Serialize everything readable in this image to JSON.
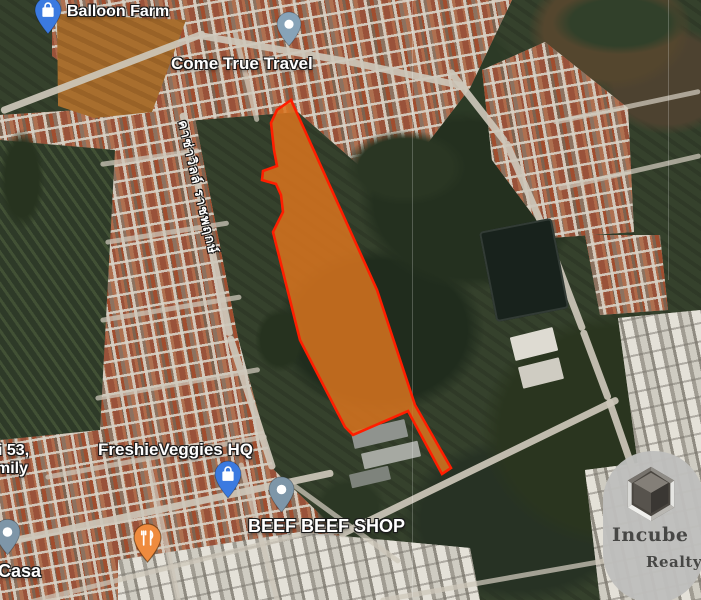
{
  "map": {
    "type": "satellite",
    "pois": {
      "balloon_farm": {
        "label": "Balloon Farm"
      },
      "come_true_travel": {
        "label": "Come True Travel"
      },
      "freshie_veggies": {
        "label": "FreshieVeggies HQ"
      },
      "beef_beef_shop": {
        "label": "BEEF BEEF SHOP"
      },
      "soi_53_partial": {
        "label": "i 53,"
      },
      "family_partial": {
        "label": "mily"
      },
      "casa_partial": {
        "label": "Casa"
      }
    },
    "road_label": {
      "text": "คาซ่าวิลล์ ราชพฤกษ์"
    },
    "label_style": {
      "text_color": "#ffffff",
      "outline_color": "#1a1a1a"
    }
  },
  "pins": {
    "balloon_farm": {
      "color": "#3b7ae0",
      "icon": "shopping-bag-icon"
    },
    "come_true_travel": {
      "color": "#87a3b8",
      "icon": "dot-icon"
    },
    "freshie_veggies": {
      "color": "#3b7ae0",
      "icon": "shopping-bag-icon"
    },
    "beef_beef_shop": {
      "color": "#7e96a8",
      "icon": "dot-icon"
    },
    "restaurant": {
      "color": "#ef8b3e",
      "icon": "restaurant-icon"
    },
    "casa": {
      "color": "#7e96a8",
      "icon": "dot-icon"
    }
  },
  "parcel": {
    "description": "highlighted land parcel",
    "fill": "#d9741f",
    "fill_opacity": "0.85",
    "stroke": "#ff1e00",
    "stroke_width": "2.6",
    "path": "M291,100 L277,110 L271,123 L274,150 L277,166 L263,171 L262,180 L276,184 L281,195 L283,212 L273,232 L300,340 L345,427 L353,435 L408,411 L442,474 L451,468 L415,405 L377,290 Z"
  },
  "watermark": {
    "line1": "Incube",
    "line2": "Realty",
    "badge_color": "rgba(190,190,188,0.96)",
    "text_color": "#474745",
    "icon": "cube-icon"
  }
}
